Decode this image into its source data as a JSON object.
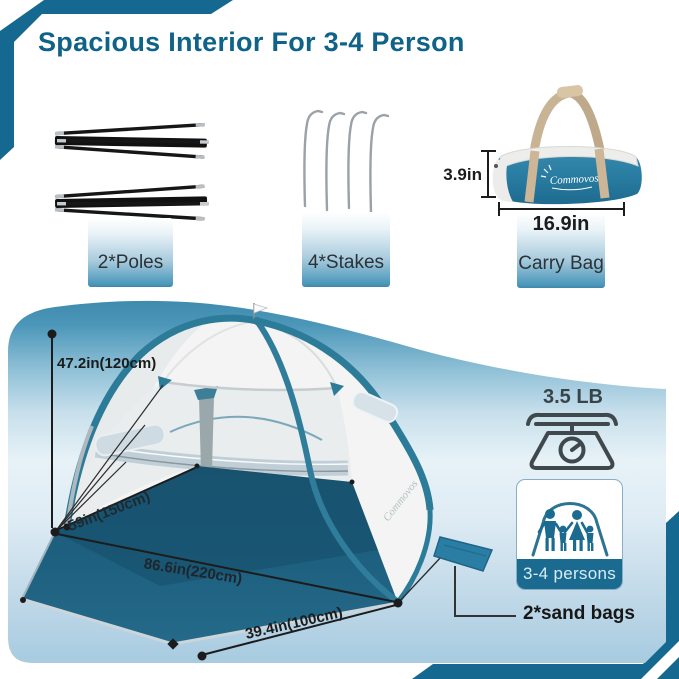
{
  "title": "Spacious Interior For 3-4 Person",
  "brand": "Commovos",
  "components": {
    "poles_label": "2*Poles",
    "stakes_label": "4*Stakes",
    "carry_bag_label": "Carry Bag"
  },
  "carry_bag_dims": {
    "height": "3.9in",
    "length": "16.9in"
  },
  "tent_dims": {
    "height": "47.2in(120cm)",
    "depth": "59in(150cm)",
    "width": "86.6in(220cm)",
    "front_width": "39.4in(100cm)"
  },
  "specs": {
    "weight": "3.5 LB",
    "capacity": "3-4 persons",
    "sand_bags": "2*sand bags"
  },
  "icons": {
    "weight": "kitchen-scale-icon",
    "capacity": "family-in-tent-icon",
    "flag": "tent-top-flag-icon"
  },
  "colors": {
    "accent_teal": "#0f6288",
    "corner_band_teal": "#15688f",
    "floor_teal": "#1e6080",
    "badge_teal": "#1b6a90",
    "box_gradient_bottom": "#4793b8",
    "strap_tan": "#c9b395"
  }
}
